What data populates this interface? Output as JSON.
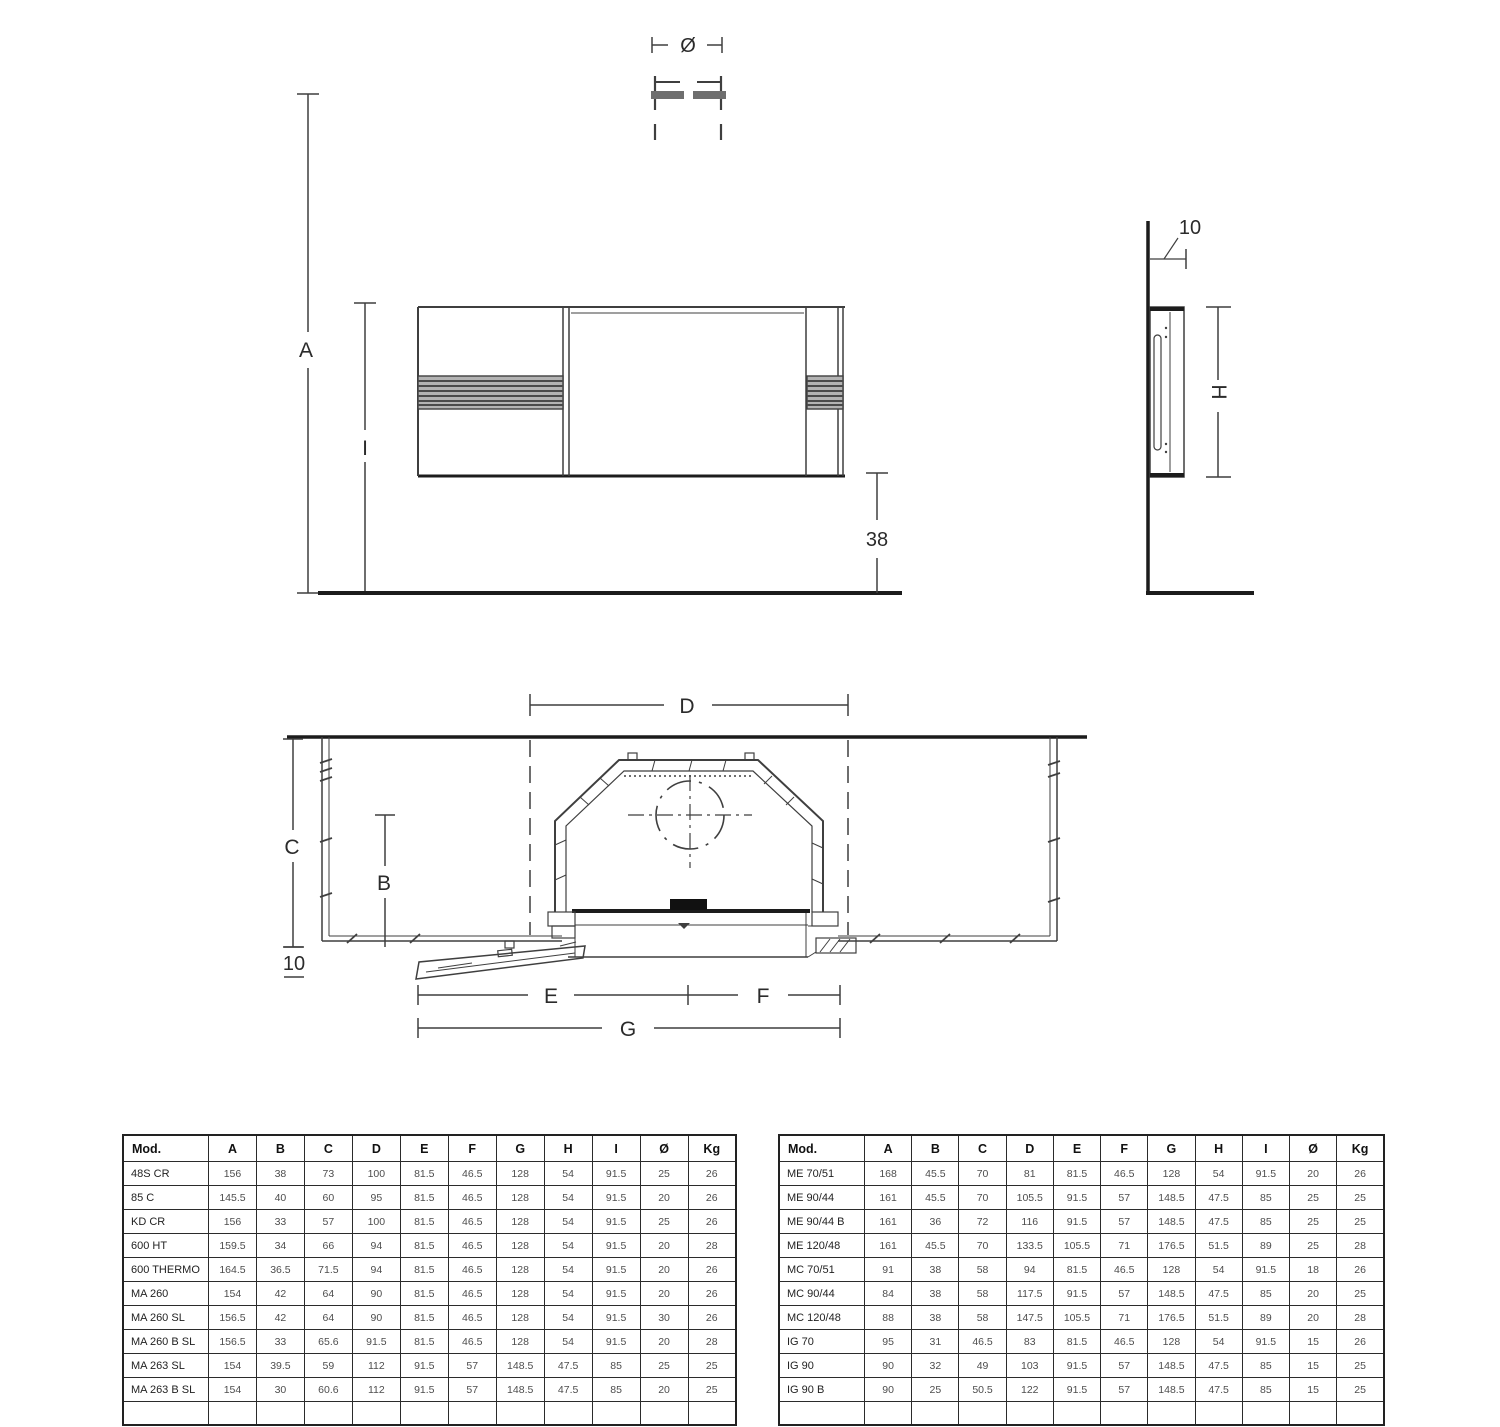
{
  "drawing": {
    "front": {
      "dim_a": "A",
      "dim_i": "I",
      "dim_38": "38",
      "dim_diameter": "Ø"
    },
    "side": {
      "dim_10": "10",
      "dim_h": "H"
    },
    "plan": {
      "dim_d": "D",
      "dim_c": "C",
      "dim_b": "B",
      "dim_10": "10",
      "dim_e": "E",
      "dim_f": "F",
      "dim_g": "G"
    }
  },
  "tables": {
    "left": {
      "headers": [
        "Mod.",
        "A",
        "B",
        "C",
        "D",
        "E",
        "F",
        "G",
        "H",
        "I",
        "Ø",
        "Kg"
      ],
      "rows": [
        [
          "48S CR",
          "156",
          "38",
          "73",
          "100",
          "81.5",
          "46.5",
          "128",
          "54",
          "91.5",
          "25",
          "26"
        ],
        [
          "85 C",
          "145.5",
          "40",
          "60",
          "95",
          "81.5",
          "46.5",
          "128",
          "54",
          "91.5",
          "20",
          "26"
        ],
        [
          "KD CR",
          "156",
          "33",
          "57",
          "100",
          "81.5",
          "46.5",
          "128",
          "54",
          "91.5",
          "25",
          "26"
        ],
        [
          "600 HT",
          "159.5",
          "34",
          "66",
          "94",
          "81.5",
          "46.5",
          "128",
          "54",
          "91.5",
          "20",
          "28"
        ],
        [
          "600 THERMO",
          "164.5",
          "36.5",
          "71.5",
          "94",
          "81.5",
          "46.5",
          "128",
          "54",
          "91.5",
          "20",
          "26"
        ],
        [
          "MA 260",
          "154",
          "42",
          "64",
          "90",
          "81.5",
          "46.5",
          "128",
          "54",
          "91.5",
          "20",
          "26"
        ],
        [
          "MA 260 SL",
          "156.5",
          "42",
          "64",
          "90",
          "81.5",
          "46.5",
          "128",
          "54",
          "91.5",
          "30",
          "26"
        ],
        [
          "MA 260 B SL",
          "156.5",
          "33",
          "65.6",
          "91.5",
          "81.5",
          "46.5",
          "128",
          "54",
          "91.5",
          "20",
          "28"
        ],
        [
          "MA 263 SL",
          "154",
          "39.5",
          "59",
          "112",
          "91.5",
          "57",
          "148.5",
          "47.5",
          "85",
          "25",
          "25"
        ],
        [
          "MA 263 B SL",
          "154",
          "30",
          "60.6",
          "112",
          "91.5",
          "57",
          "148.5",
          "47.5",
          "85",
          "20",
          "25"
        ]
      ],
      "clipped_row": true
    },
    "right": {
      "headers": [
        "Mod.",
        "A",
        "B",
        "C",
        "D",
        "E",
        "F",
        "G",
        "H",
        "I",
        "Ø",
        "Kg"
      ],
      "rows": [
        [
          "ME 70/51",
          "168",
          "45.5",
          "70",
          "81",
          "81.5",
          "46.5",
          "128",
          "54",
          "91.5",
          "20",
          "26"
        ],
        [
          "ME 90/44",
          "161",
          "45.5",
          "70",
          "105.5",
          "91.5",
          "57",
          "148.5",
          "47.5",
          "85",
          "25",
          "25"
        ],
        [
          "ME 90/44 B",
          "161",
          "36",
          "72",
          "116",
          "91.5",
          "57",
          "148.5",
          "47.5",
          "85",
          "25",
          "25"
        ],
        [
          "ME 120/48",
          "161",
          "45.5",
          "70",
          "133.5",
          "105.5",
          "71",
          "176.5",
          "51.5",
          "89",
          "25",
          "28"
        ],
        [
          "MC 70/51",
          "91",
          "38",
          "58",
          "94",
          "81.5",
          "46.5",
          "128",
          "54",
          "91.5",
          "18",
          "26"
        ],
        [
          "MC 90/44",
          "84",
          "38",
          "58",
          "117.5",
          "91.5",
          "57",
          "148.5",
          "47.5",
          "85",
          "20",
          "25"
        ],
        [
          "MC 120/48",
          "88",
          "38",
          "58",
          "147.5",
          "105.5",
          "71",
          "176.5",
          "51.5",
          "89",
          "20",
          "28"
        ],
        [
          "IG 70",
          "95",
          "31",
          "46.5",
          "83",
          "81.5",
          "46.5",
          "128",
          "54",
          "91.5",
          "15",
          "26"
        ],
        [
          "IG 90",
          "90",
          "32",
          "49",
          "103",
          "91.5",
          "57",
          "148.5",
          "47.5",
          "85",
          "15",
          "25"
        ],
        [
          "IG 90 B",
          "90",
          "25",
          "50.5",
          "122",
          "91.5",
          "57",
          "148.5",
          "47.5",
          "85",
          "15",
          "25"
        ]
      ],
      "clipped_row": true
    }
  }
}
